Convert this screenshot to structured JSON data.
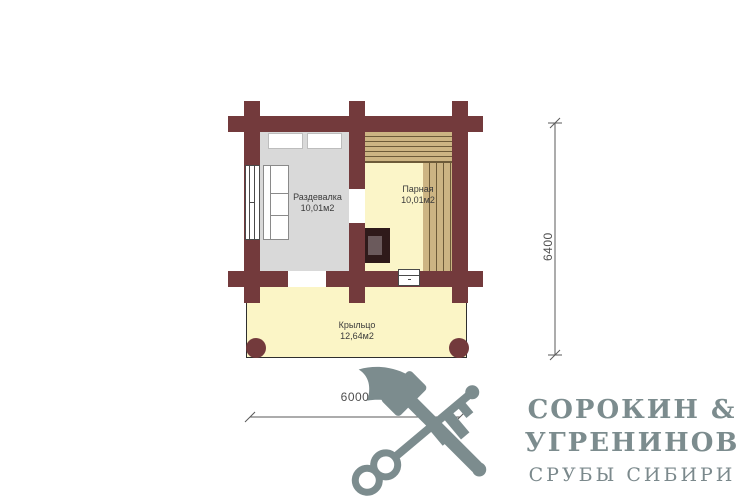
{
  "plan": {
    "rooms": {
      "razdevalka": {
        "name": "Раздевалка",
        "area": "10,01м2"
      },
      "parnaya": {
        "name": "Парная",
        "area": "10,01м2"
      },
      "kryltso": {
        "name": "Крыльцо",
        "area": "12,64м2"
      }
    },
    "dimensions": {
      "height": "6400",
      "width": "6000"
    }
  },
  "logo": {
    "title_line1": "СОРОКИН &",
    "title_line2": "УГРЕНИНОВ",
    "subtitle": "СРУБЫ СИБИРИ",
    "icon": "crossed-axe-and-key"
  },
  "palette": {
    "wall": "#733a3c",
    "razdevalka_floor": "#d9d9d9",
    "parnaya_floor": "#fbf5c8",
    "porch_floor": "#fbf5c6",
    "bench_wood": "#ccb483",
    "bench_line": "#6d5b39",
    "stove_outer": "#2f1a1a",
    "stove_inner": "#6b5a5c",
    "logo_color": "#7c8c8e",
    "logo_subtitle": "#7b898c",
    "label_text": "#3b3b3b",
    "dimension_text": "#4f4f4f"
  }
}
